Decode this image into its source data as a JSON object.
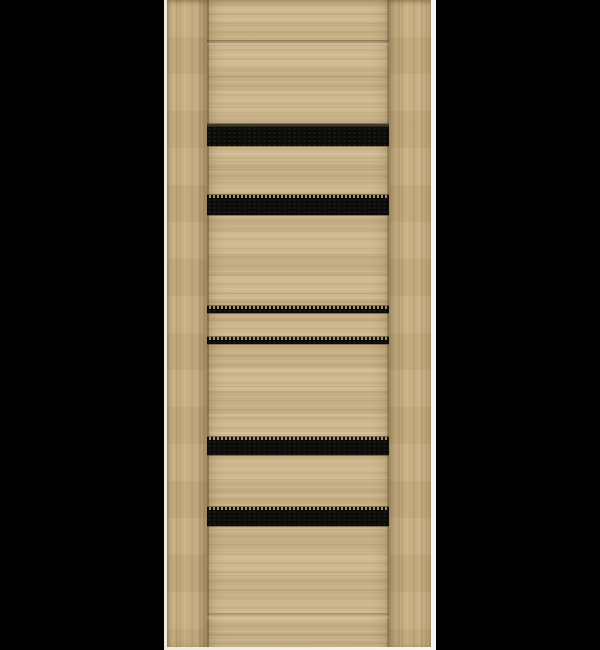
{
  "image": {
    "width": 600,
    "height": 650,
    "description": "Product render of an interior door with light oak woodgrain finish and six horizontal black glass inserts, shown on a plain black background. No text, labels or hardware visible."
  },
  "colors": {
    "background": "#000000",
    "door_edge": "#f3efe7",
    "wood_base": "#cbb488",
    "wood_light": "#d6c197",
    "wood_stile": "#c7ad80",
    "seam": "#8f7a55",
    "glass": "#0b0b09",
    "glass_dot": "#a8906a"
  },
  "door": {
    "left": 164,
    "top": 0,
    "width": 272,
    "height": 650,
    "edge_left_width": 3,
    "edge_right_width": 5,
    "edge_bottom_height": 3,
    "stile_left_width": 40,
    "stile_right_width": 42,
    "rail_top_groove_y": 40,
    "rail_bottom_groove_y": 613,
    "glass_strips": [
      {
        "top": 124,
        "height": 22,
        "dotted_top": false
      },
      {
        "top": 195,
        "height": 20,
        "dotted_top": true
      },
      {
        "top": 306,
        "height": 7,
        "dotted_top": true
      },
      {
        "top": 337,
        "height": 7,
        "dotted_top": true
      },
      {
        "top": 437,
        "height": 18,
        "dotted_top": true
      },
      {
        "top": 507,
        "height": 19,
        "dotted_top": true
      }
    ]
  }
}
